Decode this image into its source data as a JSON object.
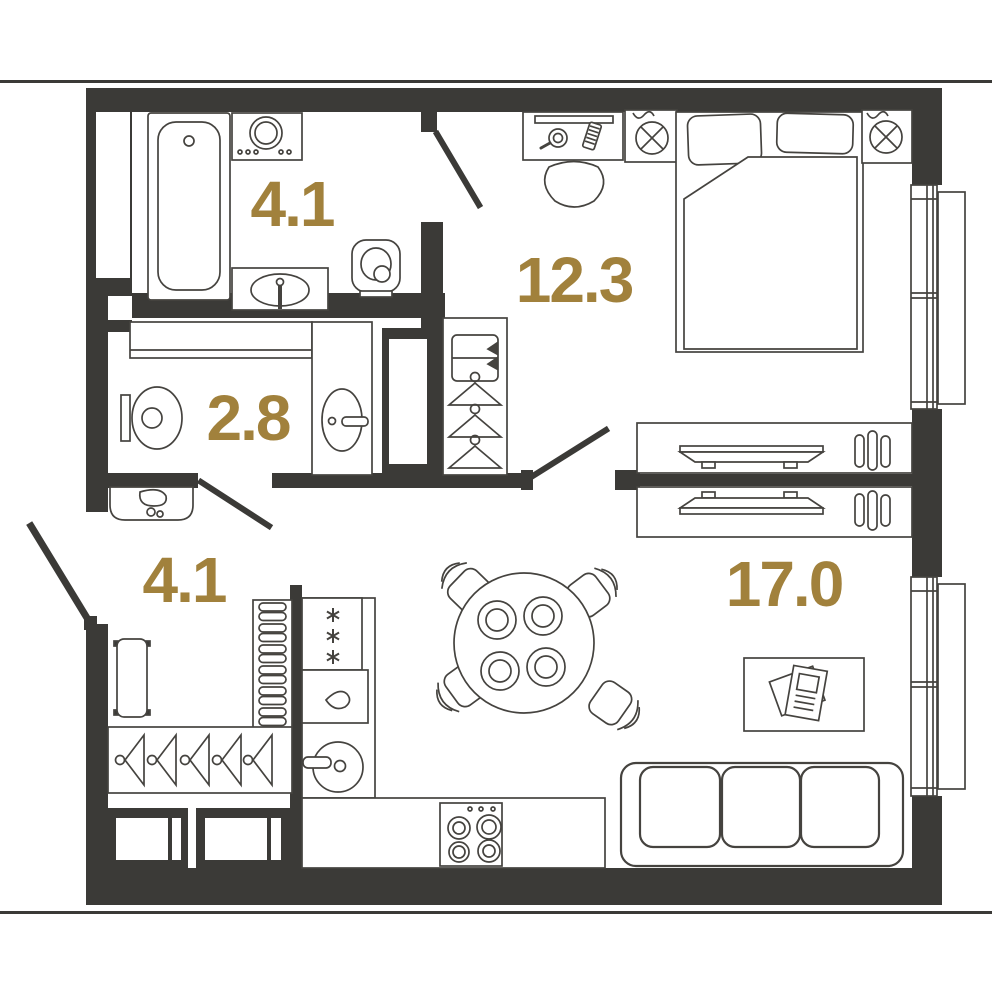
{
  "plan": {
    "title": "apartment-floor-plan",
    "rooms": [
      {
        "name": "bathroom",
        "area": "4.1"
      },
      {
        "name": "bedroom",
        "area": "12.3"
      },
      {
        "name": "toilet",
        "area": "2.8"
      },
      {
        "name": "hallway",
        "area": "4.1"
      },
      {
        "name": "living-kitchen",
        "area": "17.0"
      }
    ],
    "colors": {
      "wall": "#3b3a37",
      "furniture_line": "#45433f",
      "area_label": "#a1813c",
      "background": "#ffffff"
    },
    "icons": [
      "bathtub-icon",
      "washing-machine-icon",
      "washbasin-icon",
      "toilet-icon",
      "bed-icon",
      "pillow-icon",
      "wall-lamp-icon",
      "desk-icon",
      "monitor-icon",
      "mouse-icon",
      "keyboard-icon",
      "chair-icon",
      "wardrobe-hanger-icon",
      "shelf-box-icon",
      "duct-shaft-icon",
      "tv-stand-icon",
      "window-icon",
      "door-leaf-icon",
      "pouf-icon",
      "bench-icon",
      "shoe-rack-icon",
      "coat-hanger-icon",
      "cabinet-icon",
      "fridge-snowflake-icon",
      "drop-icon",
      "kitchen-sink-icon",
      "hob-icon",
      "dining-table-icon",
      "plate-icon",
      "coffee-table-icon",
      "magazine-icon",
      "sofa-icon"
    ]
  }
}
